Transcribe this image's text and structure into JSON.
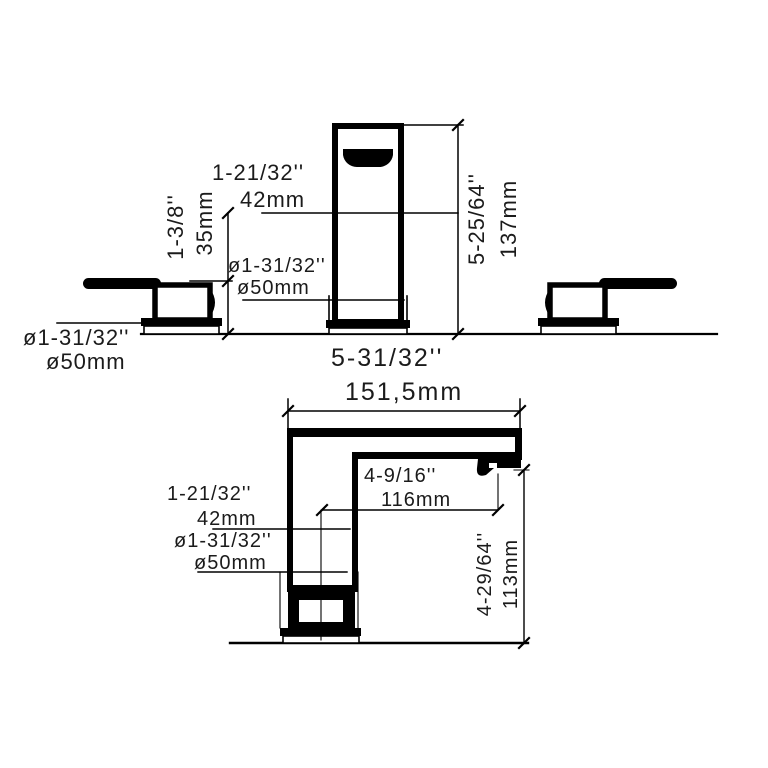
{
  "page": {
    "background": "#ffffff",
    "ink": "#000000",
    "text_color": "#1b1b1b",
    "drawing_type": "faucet-dimension-diagram"
  },
  "front_view": {
    "spout_upper_height": {
      "inches": "1-21/32''",
      "mm": "42mm"
    },
    "handle_height": {
      "inches": "1-3/8''",
      "mm": "35mm"
    },
    "spout_base_diameter": {
      "inches": "ø1-31/32''",
      "mm": "ø50mm"
    },
    "handle_base_diameter": {
      "inches": "ø1-31/32''",
      "mm": "ø50mm"
    },
    "overall_height": {
      "inches": "5-25/64''",
      "mm": "137mm"
    },
    "overall_width": {
      "inches": "5-31/32''",
      "mm": "151,5mm"
    }
  },
  "side_view": {
    "spout_reach": {
      "inches": "4-9/16''",
      "mm": "116mm"
    },
    "body_width": {
      "inches": "1-21/32''",
      "mm": "42mm"
    },
    "base_diameter": {
      "inches": "ø1-31/32''",
      "mm": "ø50mm"
    },
    "spout_outlet_height": {
      "inches": "4-29/64''",
      "mm": "113mm"
    }
  }
}
